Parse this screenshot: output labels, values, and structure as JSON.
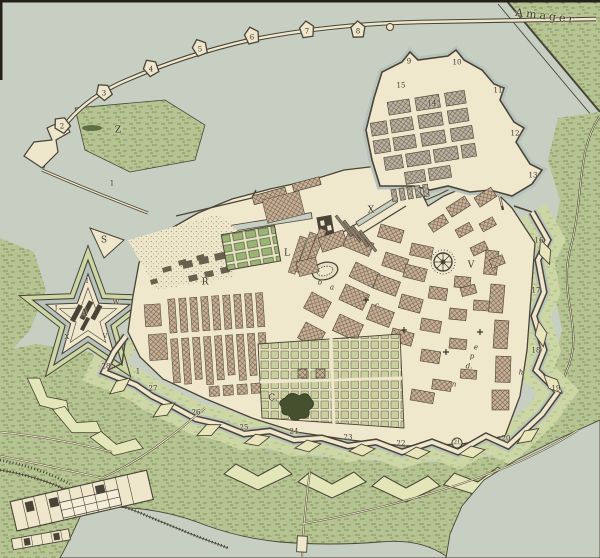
{
  "map": {
    "region_title": "Amager",
    "colors": {
      "sea": "#c6cfc2",
      "parchment": "#f0e8cd",
      "countryside": "#b5c492",
      "glacis": "#cdd7a6",
      "moat": "#b7c2ba",
      "city_blocks": "#c9b197",
      "ink": "#4a4337"
    },
    "labels": [
      {
        "id": "amager",
        "t": "Amager",
        "x": 546,
        "y": 16,
        "k": "region"
      },
      {
        "id": "zone-z",
        "t": "Z",
        "x": 118,
        "y": 131,
        "k": "zone"
      },
      {
        "id": "zone-x-basin",
        "t": "X",
        "x": 371,
        "y": 211,
        "k": "zone"
      },
      {
        "id": "zone-v",
        "t": "V",
        "x": 471,
        "y": 266,
        "k": "zone"
      },
      {
        "id": "zone-s",
        "t": "S",
        "x": 104,
        "y": 241,
        "k": "zone"
      },
      {
        "id": "zone-c-garden",
        "t": "C.",
        "x": 273,
        "y": 399,
        "k": "zone"
      },
      {
        "id": "zone-r",
        "t": "R",
        "x": 205,
        "y": 283,
        "k": "zone"
      },
      {
        "id": "zone-l",
        "t": "L",
        "x": 287,
        "y": 254,
        "k": "zone"
      },
      {
        "id": "citadel-a",
        "t": "A",
        "x": 84,
        "y": 314,
        "k": "zone"
      },
      {
        "id": "citadel-i",
        "t": "I",
        "x": 87,
        "y": 281,
        "k": "cit"
      },
      {
        "id": "citadel-j",
        "t": "J",
        "x": 56,
        "y": 308,
        "k": "cit"
      },
      {
        "id": "citadel-w",
        "t": "W",
        "x": 116,
        "y": 302,
        "k": "cit"
      },
      {
        "id": "citadel-x",
        "t": "X",
        "x": 67,
        "y": 337,
        "k": "cit"
      },
      {
        "id": "citadel-v",
        "t": "V",
        "x": 105,
        "y": 336,
        "k": "cit"
      },
      {
        "id": "bastion-1a",
        "t": "1",
        "x": 112,
        "y": 184,
        "k": "num"
      },
      {
        "id": "bastion-2",
        "t": "2",
        "x": 62,
        "y": 127,
        "k": "num"
      },
      {
        "id": "bastion-3",
        "t": "3",
        "x": 104,
        "y": 94,
        "k": "num"
      },
      {
        "id": "bastion-4",
        "t": "4",
        "x": 151,
        "y": 70,
        "k": "num"
      },
      {
        "id": "bastion-5",
        "t": "5",
        "x": 200,
        "y": 50,
        "k": "num"
      },
      {
        "id": "bastion-6",
        "t": "6",
        "x": 252,
        "y": 38,
        "k": "num"
      },
      {
        "id": "bastion-7",
        "t": "7",
        "x": 307,
        "y": 32,
        "k": "num"
      },
      {
        "id": "bastion-8",
        "t": "8",
        "x": 358,
        "y": 32,
        "k": "num"
      },
      {
        "id": "bastion-9",
        "t": "9",
        "x": 409,
        "y": 62,
        "k": "num"
      },
      {
        "id": "bastion-10",
        "t": "10",
        "x": 457,
        "y": 63,
        "k": "num"
      },
      {
        "id": "bastion-11",
        "t": "11",
        "x": 498,
        "y": 91,
        "k": "num"
      },
      {
        "id": "bastion-12",
        "t": "12",
        "x": 515,
        "y": 134,
        "k": "num"
      },
      {
        "id": "bastion-13",
        "t": "13",
        "x": 533,
        "y": 176,
        "k": "num"
      },
      {
        "id": "district-14",
        "t": "14",
        "x": 432,
        "y": 104,
        "k": "num"
      },
      {
        "id": "district-15",
        "t": "15",
        "x": 401,
        "y": 86,
        "k": "num"
      },
      {
        "id": "bastion-16",
        "t": "16",
        "x": 539,
        "y": 241,
        "k": "num"
      },
      {
        "id": "bastion-17",
        "t": "17",
        "x": 536,
        "y": 291,
        "k": "num"
      },
      {
        "id": "bastion-18",
        "t": "18",
        "x": 536,
        "y": 351,
        "k": "num"
      },
      {
        "id": "bastion-19",
        "t": "19",
        "x": 556,
        "y": 389,
        "k": "num"
      },
      {
        "id": "bastion-20",
        "t": "20",
        "x": 506,
        "y": 439,
        "k": "num"
      },
      {
        "id": "bastion-21",
        "t": "21",
        "x": 457,
        "y": 443,
        "k": "numc"
      },
      {
        "id": "bastion-22",
        "t": "22",
        "x": 401,
        "y": 444,
        "k": "num"
      },
      {
        "id": "bastion-23",
        "t": "23",
        "x": 348,
        "y": 438,
        "k": "num"
      },
      {
        "id": "bastion-24",
        "t": "24",
        "x": 294,
        "y": 432,
        "k": "num"
      },
      {
        "id": "bastion-25",
        "t": "25",
        "x": 244,
        "y": 428,
        "k": "num"
      },
      {
        "id": "bastion-26",
        "t": "26",
        "x": 196,
        "y": 413,
        "k": "num"
      },
      {
        "id": "bastion-27",
        "t": "27",
        "x": 153,
        "y": 389,
        "k": "num"
      },
      {
        "id": "bastion-28",
        "t": "28",
        "x": 106,
        "y": 367,
        "k": "num"
      },
      {
        "id": "bastion-1b",
        "t": "1",
        "x": 138,
        "y": 372,
        "k": "num"
      },
      {
        "id": "letter-a",
        "t": "a",
        "x": 332,
        "y": 288,
        "k": "sm"
      },
      {
        "id": "letter-b",
        "t": "b",
        "x": 320,
        "y": 283,
        "k": "sm"
      },
      {
        "id": "letter-c",
        "t": "c",
        "x": 377,
        "y": 306,
        "k": "sm"
      },
      {
        "id": "letter-e",
        "t": "e",
        "x": 476,
        "y": 348,
        "k": "sm"
      },
      {
        "id": "letter-p",
        "t": "p",
        "x": 472,
        "y": 357,
        "k": "sm"
      },
      {
        "id": "letter-d",
        "t": "d.",
        "x": 469,
        "y": 367,
        "k": "sm"
      },
      {
        "id": "letter-n",
        "t": "n",
        "x": 454,
        "y": 385,
        "k": "sm"
      },
      {
        "id": "letter-h",
        "t": "h",
        "x": 521,
        "y": 373,
        "k": "sm"
      }
    ]
  }
}
